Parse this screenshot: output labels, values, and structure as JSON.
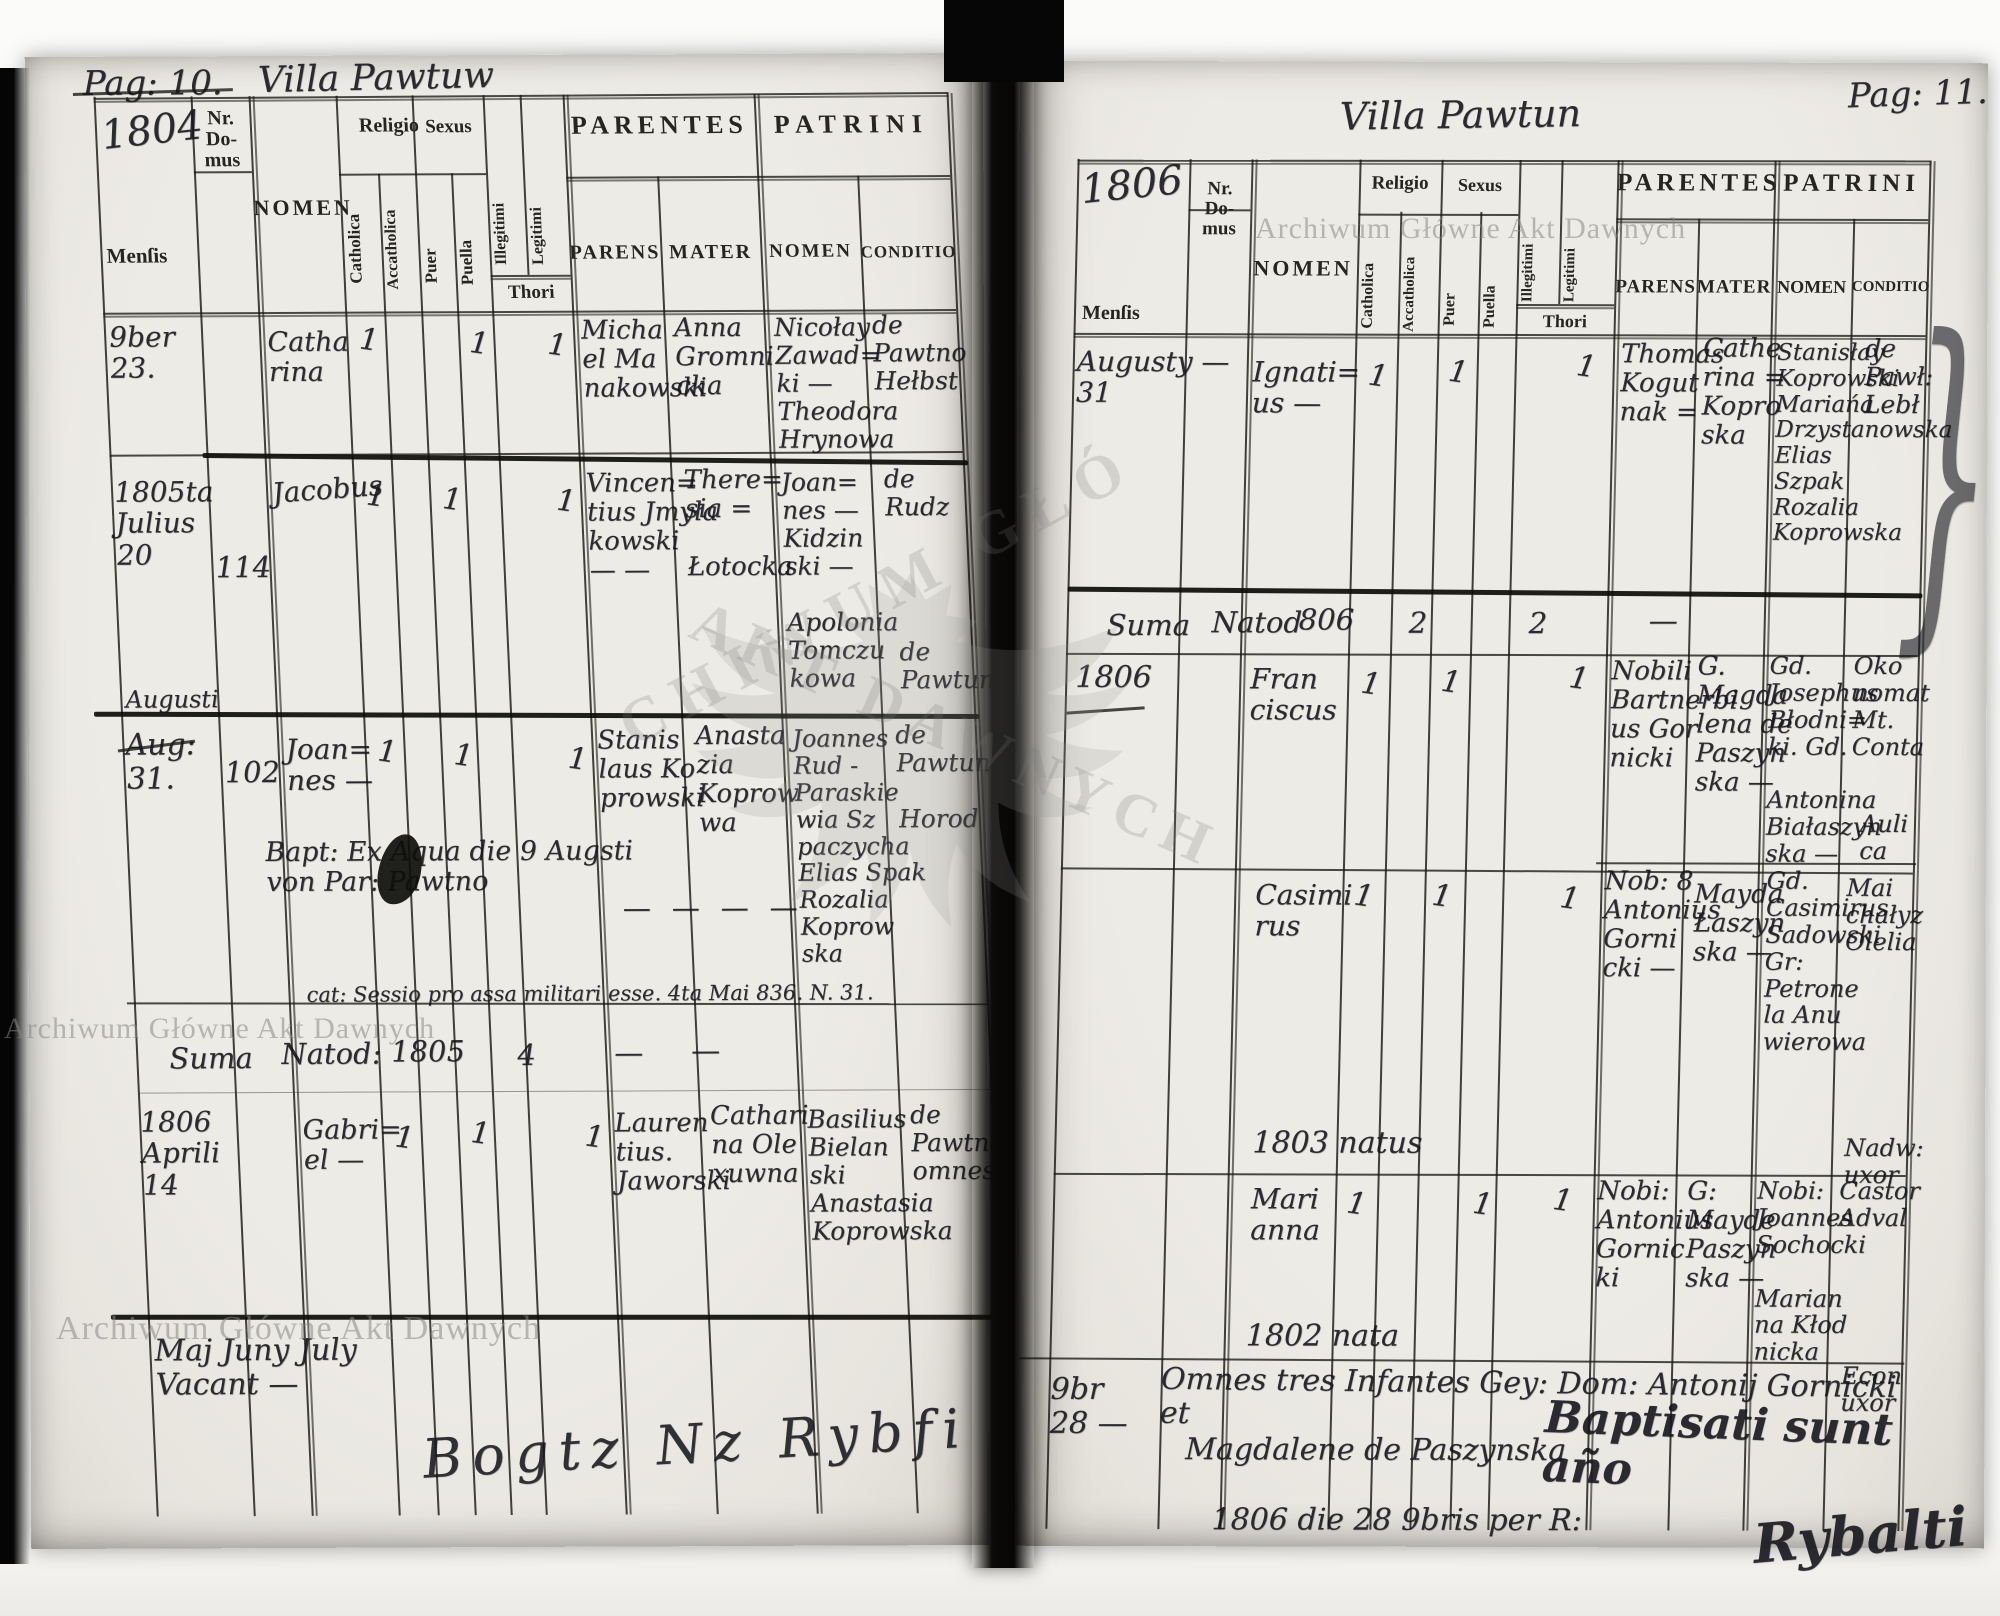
{
  "colors": {
    "paper": "#eceae4",
    "ink": "#16161d",
    "rule": "#1a1914",
    "watermark_gray": "#878787"
  },
  "watermark": {
    "text_top_right": "Archiwum Główne Akt Dawnych",
    "text_mid_left": "Archiwum Główne Akt Dawnych",
    "text_bottom_left": "Archiwum Główne Akt Dawnych",
    "stamp_line1": "CHIWUM GŁÓ",
    "stamp_line2": "AKT DAWNYCH"
  },
  "headers": {
    "mensis": "Menſis",
    "nr_domus": "Nr.\nDo-\nmus",
    "nomen": "NOMEN",
    "religio": "Religio",
    "catholica": "Catholica",
    "accatholica": "Accatholica",
    "sexus": "Sexus",
    "puer": "Puer",
    "puella": "Puella",
    "illegitimi": "Illegitimi",
    "legitimi": "Legitimi",
    "thori": "Thori",
    "parentes": "PARENTES",
    "parens": "PARENS",
    "mater": "MATER",
    "patrini": "PATRINI",
    "patrini_nomen": "NOMEN",
    "conditio": "CONDITIO"
  },
  "left": {
    "page_no": "Pag: 10.",
    "villa": "Villa Pawtuw",
    "year": "1804",
    "records": [
      {
        "mensis": "9ber\n23.",
        "nomen": "Catha\nrina",
        "catholica": "1",
        "puella": "1",
        "legitimi": "1",
        "parens": "Micha\nel Ma\nnakowski",
        "mater": "Anna\nGromni\ncka",
        "patrini": "Nicołay\nZawad=\nki —\nTheodora\nHrynowa",
        "conditio": "de\nPawtno\nHełbst"
      },
      {
        "mensis": "1805ta\nJulius\n20",
        "nr_domus": "114",
        "nomen": "Jacobus",
        "catholica": "1",
        "puer": "1",
        "legitimi": "1",
        "parens": "Vincen=\ntius Jmyła\nkowski\n— —",
        "mater": "There=\nsia =\n\nŁotocka",
        "patrini": "Joan=\nnes —\nKidzin\nski —\n\nApolonia\nTomczu\nkowa",
        "conditio_a": "de\nRudz",
        "conditio_b": "de\nPawtun"
      },
      {
        "mensis": "Aug:\n31.",
        "nr_domus": "102",
        "nomen": "Joan=\nnes —",
        "catholica": "1",
        "puer": "1",
        "legitimi": "1",
        "parens": "Stanis\nlaus Ko\nprowski",
        "mater": "Anasta\nzia\nKoprow\nwa",
        "patrini": "Joannes\nRud -\nParaskie\nwia Sz\npaczycha\nElias Spak\nRozalia\nKoprow\nska",
        "conditio": "de\nPawtun\n\nHorod",
        "note_month": "Augusti",
        "note_bapt": "Bapt: Ex Aqua die 9 Augsti\nvon Par: Pawtno",
        "note_dashes": "—         —         —         —",
        "note_militari": "cat: Sessio pro assa militari esse.   4ta Mai 836. N. 31."
      },
      {
        "mensis": "1806\nAprili\n14",
        "nomen": "Gabri=\nel —",
        "catholica": "1",
        "puer": "1",
        "legitimi": "1",
        "parens": "Lauren\ntius.\nJaworski",
        "mater": "Cathari\nna Ole\nxuwna",
        "patrini": "Basilius\nBielan\nski\nAnastasia\nKoprowska",
        "conditio": "de\nPawtno\nomnes"
      }
    ],
    "summary": {
      "suma": "Suma",
      "natorum": "Natod:",
      "year": "1805",
      "puer": "4",
      "dash1": "—",
      "dash2": "—"
    },
    "footer_vacant": "Maj Juny July\nVacant —",
    "footer_scribble": "Bogtz  Nz  Rybfi"
  },
  "right": {
    "page_no": "Pag: 11.",
    "villa": "Villa Pawtun",
    "year": "1806",
    "records": [
      {
        "mensis": "Augusty —\n31",
        "nomen": "Ignati=\nus —",
        "catholica": "1",
        "puer": "1",
        "legitimi": "1",
        "parens": "Thomas\nKogut\nnak =",
        "mater": "Cathe\nrina =\nKopro\nska",
        "patrini": "Stanisłay\nKoprowski\nMariańa\nDrzystanowska\nElias\nSzpak\nRozalia\nKoprowska",
        "conditio": "de\nPawł:\nLebł",
        "brace": "}"
      },
      {
        "mensis": "1806",
        "nomen": "Fran\nciscus",
        "catholica": "1",
        "puer": "1",
        "legitimi": "1",
        "parens": "Nobili\nBartnerbi\nus Gor\nnicki",
        "mater": "G.\nMagda\nlena de\nPaszyn\nska —",
        "patrini": "Gd.\nJosephus\nBłodni=\nki. Gd.\n\nAntonina\nBiałaszyn\nska —",
        "conditio_a": "Oko\nnomat\nMt. Conta",
        "conditio_b": "Auli\nca"
      },
      {
        "nomen": "Casimi\nrus",
        "catholica": "1",
        "puer": "1",
        "legitimi": "1",
        "parens": "Nob: 8\nAntonius\nGorni\ncki —",
        "mater": "Mayda\nŁaszyn\nska —",
        "patrini": "Gd.\nCasimirus\nSadowski\nGr:\nPetrone\nla Anu\nwierowa",
        "conditio_a": "Mai\nchałyz\nOlelia",
        "conditio_b": "Nadw:\nuxor",
        "note": "1803  natus"
      },
      {
        "nomen": "Mari\nanna",
        "catholica": "1",
        "puella": "1",
        "legitimi": "1",
        "parens": "Nobi:\nAntonius\nGornic\nki",
        "mater": "G:\nMayde\nPaszyn\nska —",
        "patrini": "Nobi:\nJoannes\nSochocki\n\nMarian\nna Kłod\nnicka",
        "conditio_a": "Castor\nAdval",
        "conditio_b": "Econ\nuxor",
        "note": "1802  nata"
      },
      {
        "mensis": "9br\n28 —",
        "note1": "Omnes tres Infantes Gey: Dom: Antonij Gornicki et",
        "note2": "Magdalene de Paszynska",
        "note3": "1806 die 28 9bris per R:",
        "overlay": "Baptisati sunt año",
        "signature": "Rybalti"
      }
    ],
    "summary": {
      "suma": "Suma",
      "natorum": "Natod",
      "year": "806",
      "puer": "2",
      "legitimi": "2",
      "dash1": "—"
    }
  }
}
